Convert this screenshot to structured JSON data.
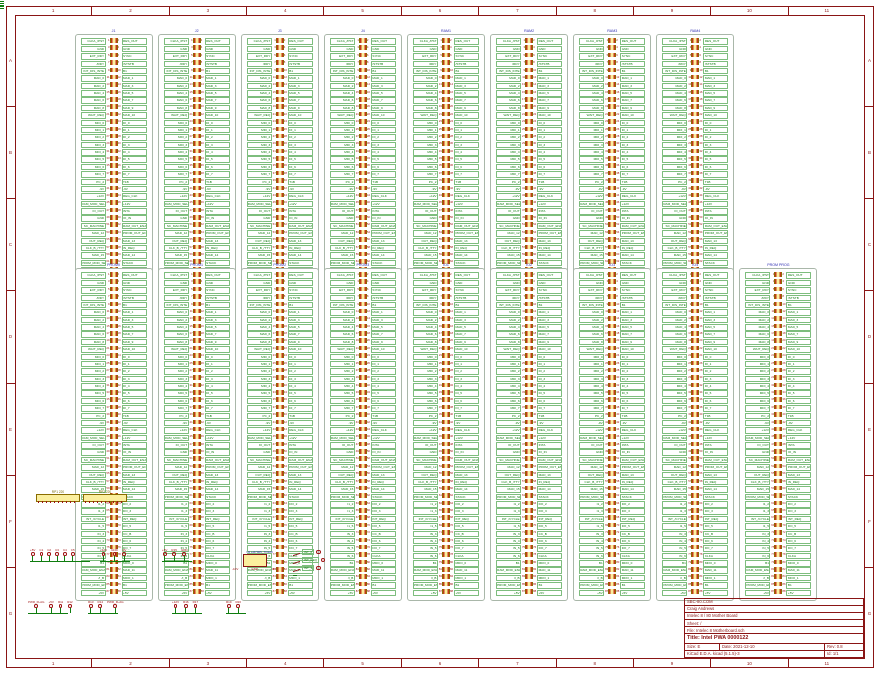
{
  "colors": {
    "frame_brown": "#8a1515",
    "net_green": "#0f7d0f",
    "pin_red": "#a01414",
    "body_yellow": "#fbef9e",
    "sheet_blue": "#2a2ab0",
    "ref_olive": "#7a6a00"
  },
  "grid": {
    "cols": [
      "1",
      "2",
      "3",
      "4",
      "5",
      "6",
      "7",
      "8",
      "9",
      "10",
      "11"
    ],
    "rows": [
      "A",
      "B",
      "C",
      "D",
      "E",
      "F",
      "G"
    ]
  },
  "title_block": {
    "company": "SBC-80.COM",
    "author": "Craig Andrews",
    "project": "Intelec 8 / 80 Mother Board",
    "sheet": "Sheet: /",
    "file": "File: Intelec 8 Motherboard.sch",
    "title": "Title: Intel PWA 0000122",
    "size": "Size: E",
    "date": "Date: 2021-12-10",
    "rev": "Rev: 0.8",
    "tool": "KiCad E.D.A.  kicad (5.1.5)-3",
    "id": "Id: 1/1"
  },
  "bus_pins": {
    "pins_per_row": 44,
    "left_labels": [
      "CLKA_/PST",
      "GND",
      "EXT_RDY",
      "/RDY",
      "INT_DIS_INTE",
      "MAD_0",
      "MAD_2",
      "MAD_4",
      "MAD_6",
      "MAD_8",
      "WAIT_REQ",
      "MDI_0",
      "MDI_1",
      "MDI_2",
      "MDI_3",
      "MDI_4",
      "MDI_5",
      "MDI_6",
      "MDI_7",
      "PC_2",
      "-9V",
      "+12V",
      "RAM_MOD_SEL",
      "IO_OUT",
      "GND",
      "SC_MACHINE",
      "MAD_12",
      "OUT_REQ",
      "CLK_B_/TTY",
      "MAD_15",
      "PROM_MOD_SEL",
      "I1_2",
      "I1_3",
      "INT_/CYCLE",
      "I1_5",
      "IN_3",
      "IN_4",
      "IN_5",
      "IN_6",
      "B1",
      "RAM_MOD_ENABLE",
      "/I_B",
      "PROM_MOD_ENABLE",
      "+5V"
    ],
    "right_labels": [
      "RES_OUT",
      "GND",
      "SYNC",
      "/STSTB",
      "B1",
      "MAD_1",
      "MAD_3",
      "MAD_5",
      "MAD_7",
      "MAD_9",
      "MAD_10",
      "DI_0",
      "DI_1",
      "DI_2",
      "DI_3",
      "DI_4",
      "DI_5",
      "DI_6",
      "DI_7",
      "T1B",
      "-9V",
      "REG_CLK",
      "+12V",
      "INTA",
      "IO_IN",
      "RAM_OUT_ENABLE",
      "PROM_OUT_ENABLE",
      "MAD_13",
      "IN_REQ",
      "MAD_14",
      "STACK",
      "DO_2",
      "DO_3",
      "INT_REQ",
      "DO_5",
      "CC_B",
      "DO_6",
      "DO_7",
      "CLKA",
      "MDO_0",
      "MAD_11",
      "MDO_1",
      "B1",
      "+5V"
    ]
  },
  "slots": {
    "top_row": [
      {
        "ref": "J1",
        "label": ""
      },
      {
        "ref": "J2",
        "label": ""
      },
      {
        "ref": "J3",
        "label": ""
      },
      {
        "ref": "J4",
        "label": ""
      },
      {
        "ref": "J5",
        "label": "RAM1"
      },
      {
        "ref": "J6",
        "label": "RAM2"
      },
      {
        "ref": "J7",
        "label": "RAM3"
      },
      {
        "ref": "J8",
        "label": "RAM4"
      }
    ],
    "bottom_row": [
      {
        "ref": "J9",
        "label": "PROM0"
      },
      {
        "ref": "J10",
        "label": "PROM1"
      },
      {
        "ref": "J11",
        "label": "PROM2"
      },
      {
        "ref": "J12",
        "label": "PROM3"
      },
      {
        "ref": "J13",
        "label": "IO1"
      },
      {
        "ref": "J14",
        "label": "IO2"
      },
      {
        "ref": "J15",
        "label": "IO3"
      },
      {
        "ref": "J16",
        "label": "IO4"
      },
      {
        "ref": "J17",
        "label": "PROM PROG"
      }
    ]
  },
  "misc": {
    "packs": [
      {
        "ref": "RP1",
        "value": "220"
      },
      {
        "ref": "RP2",
        "value": "220"
      }
    ],
    "cap_rail": {
      "items": [
        "C1",
        "C2",
        "C3",
        "C4",
        "C5"
      ],
      "top": "+5V",
      "bottom": "GND"
    },
    "power_flags": {
      "items": [
        "+12V",
        "GND",
        "-9V"
      ]
    },
    "pull_rail_a": {
      "items": [
        "+5V",
        "R15",
        "GND"
      ]
    },
    "regulator": {
      "ref": "U2",
      "value": "LM7905_TO220",
      "in": "-10V",
      "out": "-9V",
      "gnd": "GND"
    },
    "switches": {
      "items": [
        {
          "ref": "SW1",
          "net": "INT_0"
        },
        {
          "ref": "SW2",
          "net": "INT_REQ"
        },
        {
          "ref": "SW3",
          "net": "INT_1"
        }
      ],
      "common": "GND"
    },
    "pull_rail_b": {
      "items": [
        "PWR_FLAG",
        "+5V",
        "R11",
        "R12"
      ]
    },
    "pull_rail_c": {
      "items": [
        "R13",
        "R14",
        "PWR_FLAG"
      ]
    },
    "pull_rail_d": {
      "items": [
        "+12V",
        "R16",
        "R17"
      ]
    },
    "pull_rail_e": {
      "items": [
        "R19",
        "R20"
      ]
    }
  }
}
